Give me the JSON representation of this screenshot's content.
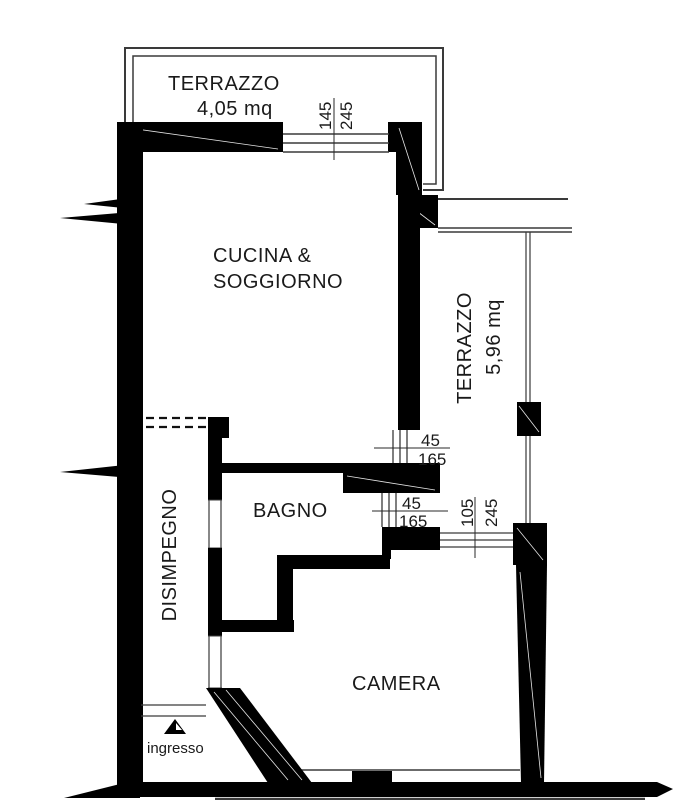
{
  "plan_title": "Apartment floor plan",
  "rooms": {
    "terrazzo_top": {
      "name": "TERRAZZO",
      "area": "4,05 mq"
    },
    "cucina_soggiorno": {
      "line1": "CUCINA &",
      "line2": "SOGGIORNO"
    },
    "terrazzo_right": {
      "name": "TERRAZZO",
      "area": "5,96 mq"
    },
    "bagno": {
      "name": "BAGNO"
    },
    "disimpegno": {
      "name": "DISIMPEGNO"
    },
    "camera": {
      "name": "CAMERA"
    },
    "ingresso": {
      "name": "ingresso"
    }
  },
  "dimensions": {
    "terrace_window": {
      "a": "145",
      "b": "245"
    },
    "bagno_window_upper": {
      "a": "45",
      "b": "165"
    },
    "bagno_window_lower": {
      "a": "45",
      "b": "165"
    },
    "camera_window": {
      "a": "105",
      "b": "245"
    }
  },
  "colors": {
    "wall": "#000000",
    "line": "#3a3a3a",
    "text": "#1a1a1a",
    "background": "#ffffff"
  }
}
